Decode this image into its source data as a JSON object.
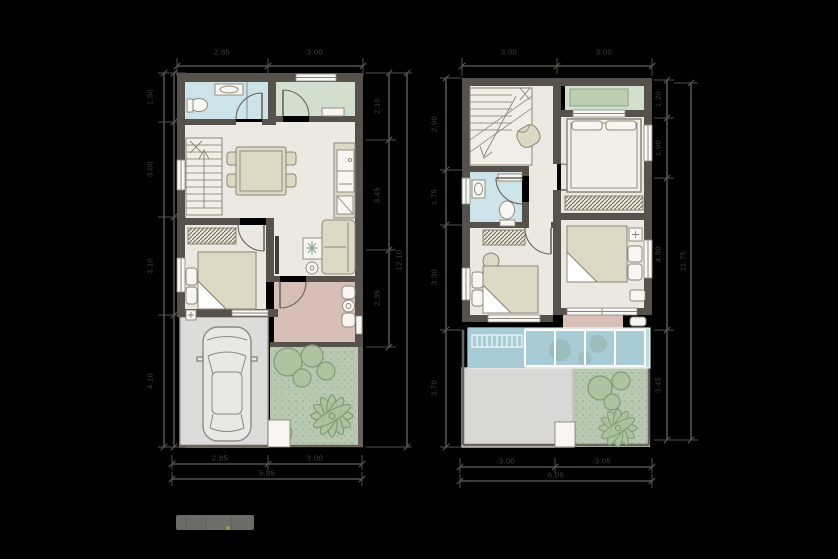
{
  "document": {
    "kind": "two-storey townhome floor plans, first and second floor"
  },
  "colors": {
    "bg": "#000000",
    "wall": "#57514b",
    "wall2": "#6a645d",
    "floor": "#ebe9e1",
    "bath": "#cce3e9",
    "porch": "#d3dfce",
    "porchdark": "#bccfb1",
    "bedfloor": "#eae8e0",
    "terr": "#d7bfb8",
    "garage": "#dcdcdb",
    "garden": "#b9c8b1",
    "tree": "#7f9b78",
    "treefill": "#aec29f",
    "furn": "#ddd9c5",
    "white": "#f7f6f2",
    "pool": "#a7ccd6",
    "pool2": "#bddde3",
    "roof": "#d8d8d6",
    "line": "#8a8578",
    "dimline": "#55504a",
    "dimtext": "#45413c"
  },
  "floor1": {
    "dims": {
      "top": [
        "2.85",
        "3.00"
      ],
      "bottom": [
        "2.85",
        "3.00"
      ],
      "bottom_overall": "5.85",
      "left": [
        "1.50",
        "3.00",
        "3.10",
        "4.10"
      ],
      "right": [
        "2.10",
        "3.45",
        "2.35"
      ],
      "right_overall": "12.10"
    }
  },
  "floor2": {
    "dims": {
      "top": [
        "3.00",
        "3.00"
      ],
      "bottom": [
        "3.00",
        "3.05"
      ],
      "bottom_overall": "6.05",
      "left": [
        "2.90",
        "1.75",
        "3.30",
        "3.70"
      ],
      "right": [
        "1.20",
        "1.90",
        "4.80",
        "3.45"
      ],
      "right_overall": "11.75"
    }
  },
  "watermark": {
    "text": ""
  }
}
